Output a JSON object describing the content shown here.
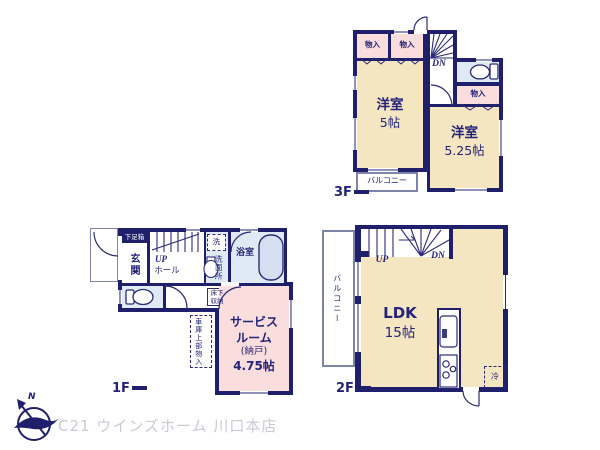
{
  "colors": {
    "wall": "#1f1f6b",
    "room_cream": "#f5e6c2",
    "room_pink": "#fadddd",
    "room_blue": "#dfeaf6",
    "logo_text": "#c8cad4"
  },
  "floor3": {
    "label": "3F",
    "rooms": {
      "closet1": "物入",
      "closet2": "物入",
      "closet3": "物入",
      "stairs_dn": "DN",
      "bedroom1": {
        "name": "洋室",
        "size": "5帖"
      },
      "bedroom2": {
        "name": "洋室",
        "size": "5.25帖"
      },
      "balcony": "バルコニー"
    }
  },
  "floor2": {
    "label": "2F",
    "rooms": {
      "stairs_up": "UP",
      "stairs_dn": "DN",
      "ldk": {
        "name": "LDK",
        "size": "15帖"
      },
      "balcony": "バルコニー",
      "fridge": "冷"
    }
  },
  "floor1": {
    "label": "1F",
    "rooms": {
      "shoe_box": "下足箱",
      "entrance": "玄関",
      "stairs_up": "UP",
      "hall": "ホール",
      "washer": "洗",
      "washroom": "洗面所",
      "bathroom": "浴室",
      "underfloor1": "床下",
      "underfloor2": "収納",
      "service_room": {
        "line1": "サービス",
        "line2": "ルーム",
        "line3": "(納戸)",
        "line4": "4.75帖"
      },
      "garage_storage": "車庫上部物入"
    }
  },
  "footer": {
    "north_mark": "N",
    "company": "C21 ウインズホーム 川口本店"
  }
}
